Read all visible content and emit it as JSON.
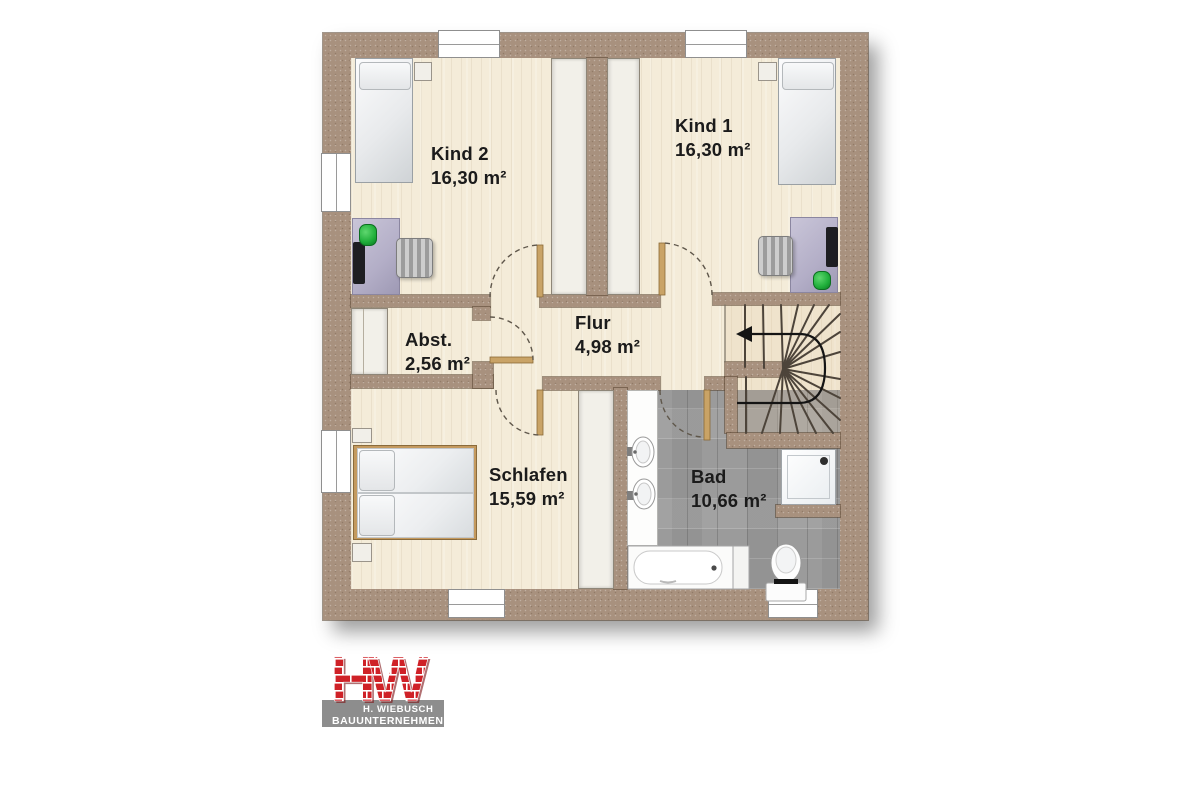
{
  "floorplan": {
    "title_hint": "upper floor plan",
    "rooms": [
      {
        "id": "kind2",
        "name": "Kind 2",
        "area": "16,30 m²"
      },
      {
        "id": "kind1",
        "name": "Kind 1",
        "area": "16,30 m²"
      },
      {
        "id": "abstellraum",
        "name": "Abst.",
        "area": "2,56 m²"
      },
      {
        "id": "flur",
        "name": "Flur",
        "area": "4,98 m²"
      },
      {
        "id": "schlafen",
        "name": "Schlafen",
        "area": "15,59 m²"
      },
      {
        "id": "bad",
        "name": "Bad",
        "area": "10,66 m²"
      }
    ],
    "fixture_icons": [
      "single-bed",
      "double-bed",
      "desk",
      "office-chair",
      "desk-lamp",
      "monitor",
      "wardrobe",
      "washbasin",
      "bathtub",
      "shower",
      "toilet",
      "winder-staircase",
      "stair-direction-arrow",
      "door-swing",
      "window"
    ],
    "colors": {
      "wall": "#a8917e",
      "floor_wood": "#f4ecd9",
      "bath_tile": "#9b9b9b",
      "fixture_white": "#ffffff",
      "door_leaf": "#c9a366",
      "label_text": "#1b1b1b"
    }
  },
  "logo": {
    "letter_h": "H",
    "letter_w": "W",
    "line1": "H. WIEBUSCH",
    "line2": "BAUUNTERNEHMEN",
    "brick_red": "#cf2127",
    "band_gray": "#8d8d8d"
  }
}
